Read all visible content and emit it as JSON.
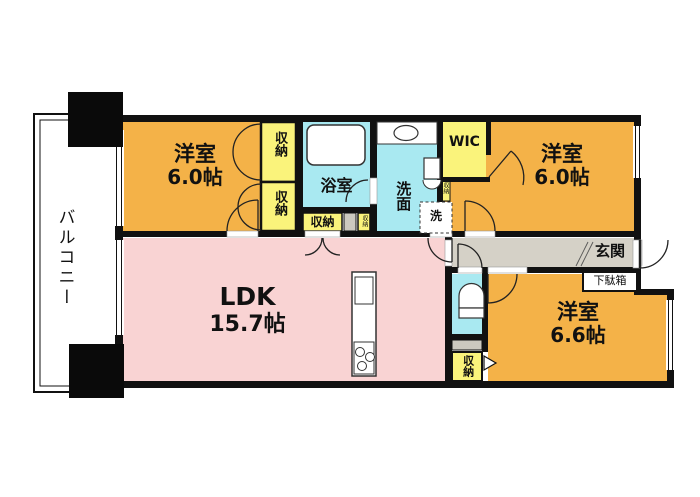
{
  "plan": {
    "balcony": {
      "label": "バルコニー"
    },
    "rooms": {
      "bedroom_top_left": {
        "name": "洋室",
        "size": "6.0帖"
      },
      "bedroom_top_right": {
        "name": "洋室",
        "size": "6.0帖"
      },
      "bedroom_bottom_right": {
        "name": "洋室",
        "size": "6.6帖"
      },
      "ldk": {
        "name": "LDK",
        "size": "15.7帖"
      },
      "bathroom": {
        "label": "浴室"
      },
      "washroom": {
        "label": "洗面"
      },
      "wic": {
        "label": "WIC"
      },
      "entrance": {
        "label": "玄関"
      },
      "shoe_cabinet": {
        "label": "下駄箱"
      },
      "laundry": {
        "label": "洗"
      }
    },
    "storage_label": "収納",
    "colors": {
      "room_orange": "#F4B248",
      "storage_yellow": "#FAF37B",
      "wet_area_cyan": "#A9E9F1",
      "ldk_pink": "#F9D3D3",
      "corridor_gray": "#D5D1C7",
      "fixture_gray": "#CCC9BF",
      "wall_black": "#111111"
    }
  }
}
